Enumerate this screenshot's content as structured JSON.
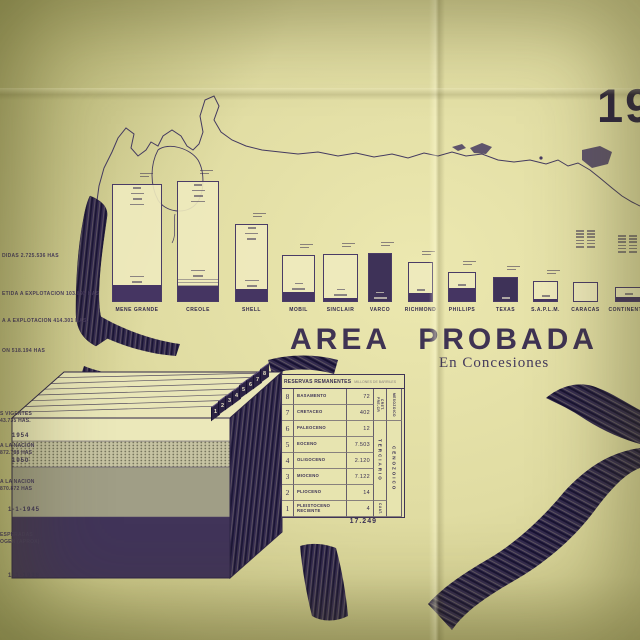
{
  "photo": {
    "year_fragment": "19"
  },
  "title_block": {
    "title": "AREA PROBADA",
    "subtitle": "En Concesiones"
  },
  "annotations_upper": [
    "DIDAS  2.725.536 HAS",
    "ETIDA A EXPLOTACION  103.893 HAS",
    "A A EXPLOTACION  414.301 HAS.",
    "ON  518.194  HAS"
  ],
  "annotations_lower": [
    {
      "line1": "S VIGENTES",
      "line2": "43.735 HAS.",
      "year": "1954"
    },
    {
      "line1": "A LA NACION",
      "line2": "872.788 HAS",
      "year": "1950"
    },
    {
      "line1": "A LA NACION",
      "line2": "870.872 HAS",
      "year": "1-1-1945"
    },
    {
      "line1": "ESPERADAS",
      "line2": "OGEN (APROX)",
      "year": "1-1-1936"
    }
  ],
  "chart_data": [
    {
      "type": "bar",
      "title": "AREA PROBADA",
      "subtitle": "En Concesiones",
      "categories": [
        "MENE GRANDE",
        "CREOLE",
        "SHELL",
        "MOBIL",
        "SINCLAIR",
        "VARCO",
        "RICHMOND",
        "PHILLIPS",
        "TEXAS",
        "S.A.P.L.M.",
        "CARACAS",
        "CONTINENTAL"
      ],
      "bar_heights_px": [
        118,
        121,
        78,
        47,
        48,
        49,
        40,
        30,
        25,
        21,
        20,
        15
      ],
      "baseline_y_px": 302,
      "note": "company concession-area bars drawn over map of Venezuela; fine-print values inside bars illegible in source",
      "legend": "none",
      "grid": false
    },
    {
      "type": "table",
      "title": "RESERVAS REMANENTES",
      "units_note": "MILLONES DE BARRILES",
      "rows": [
        {
          "num": "8",
          "name": "BASAMENTO",
          "value": "72"
        },
        {
          "num": "7",
          "name": "CRETACEO",
          "value": "402"
        },
        {
          "num": "6",
          "name": "PALEOCENO",
          "value": "12"
        },
        {
          "num": "5",
          "name": "EOCENO",
          "value": "7.503"
        },
        {
          "num": "4",
          "name": "OLIGOCENO",
          "value": "2.120"
        },
        {
          "num": "3",
          "name": "MIOCENO",
          "value": "7.122"
        },
        {
          "num": "2",
          "name": "PLIOCENO",
          "value": "14"
        },
        {
          "num": "1",
          "name": "PLEISTOCENO RECIENTE",
          "value": "4"
        }
      ],
      "era_inner": [
        {
          "span": 2,
          "labels": [
            "PRE-CR",
            "CRET."
          ]
        },
        {
          "span": 5,
          "labels": [
            "TERCIARIO"
          ]
        },
        {
          "span": 1,
          "labels": [
            "CUAT."
          ]
        }
      ],
      "era_outer": [
        {
          "span": 2,
          "labels": [
            "MESOZOICO"
          ]
        },
        {
          "span": 6,
          "labels": [
            "CENOZOICO"
          ]
        }
      ],
      "total": "17.249"
    }
  ],
  "block_diagram": {
    "layer_numbers": [
      "1",
      "2",
      "3",
      "4",
      "5",
      "6",
      "7",
      "8"
    ]
  },
  "colors": {
    "paper": "#e0dca2",
    "ink": "#3a3054",
    "band_purple": "#453562",
    "dark_purple": "#3e3258"
  }
}
